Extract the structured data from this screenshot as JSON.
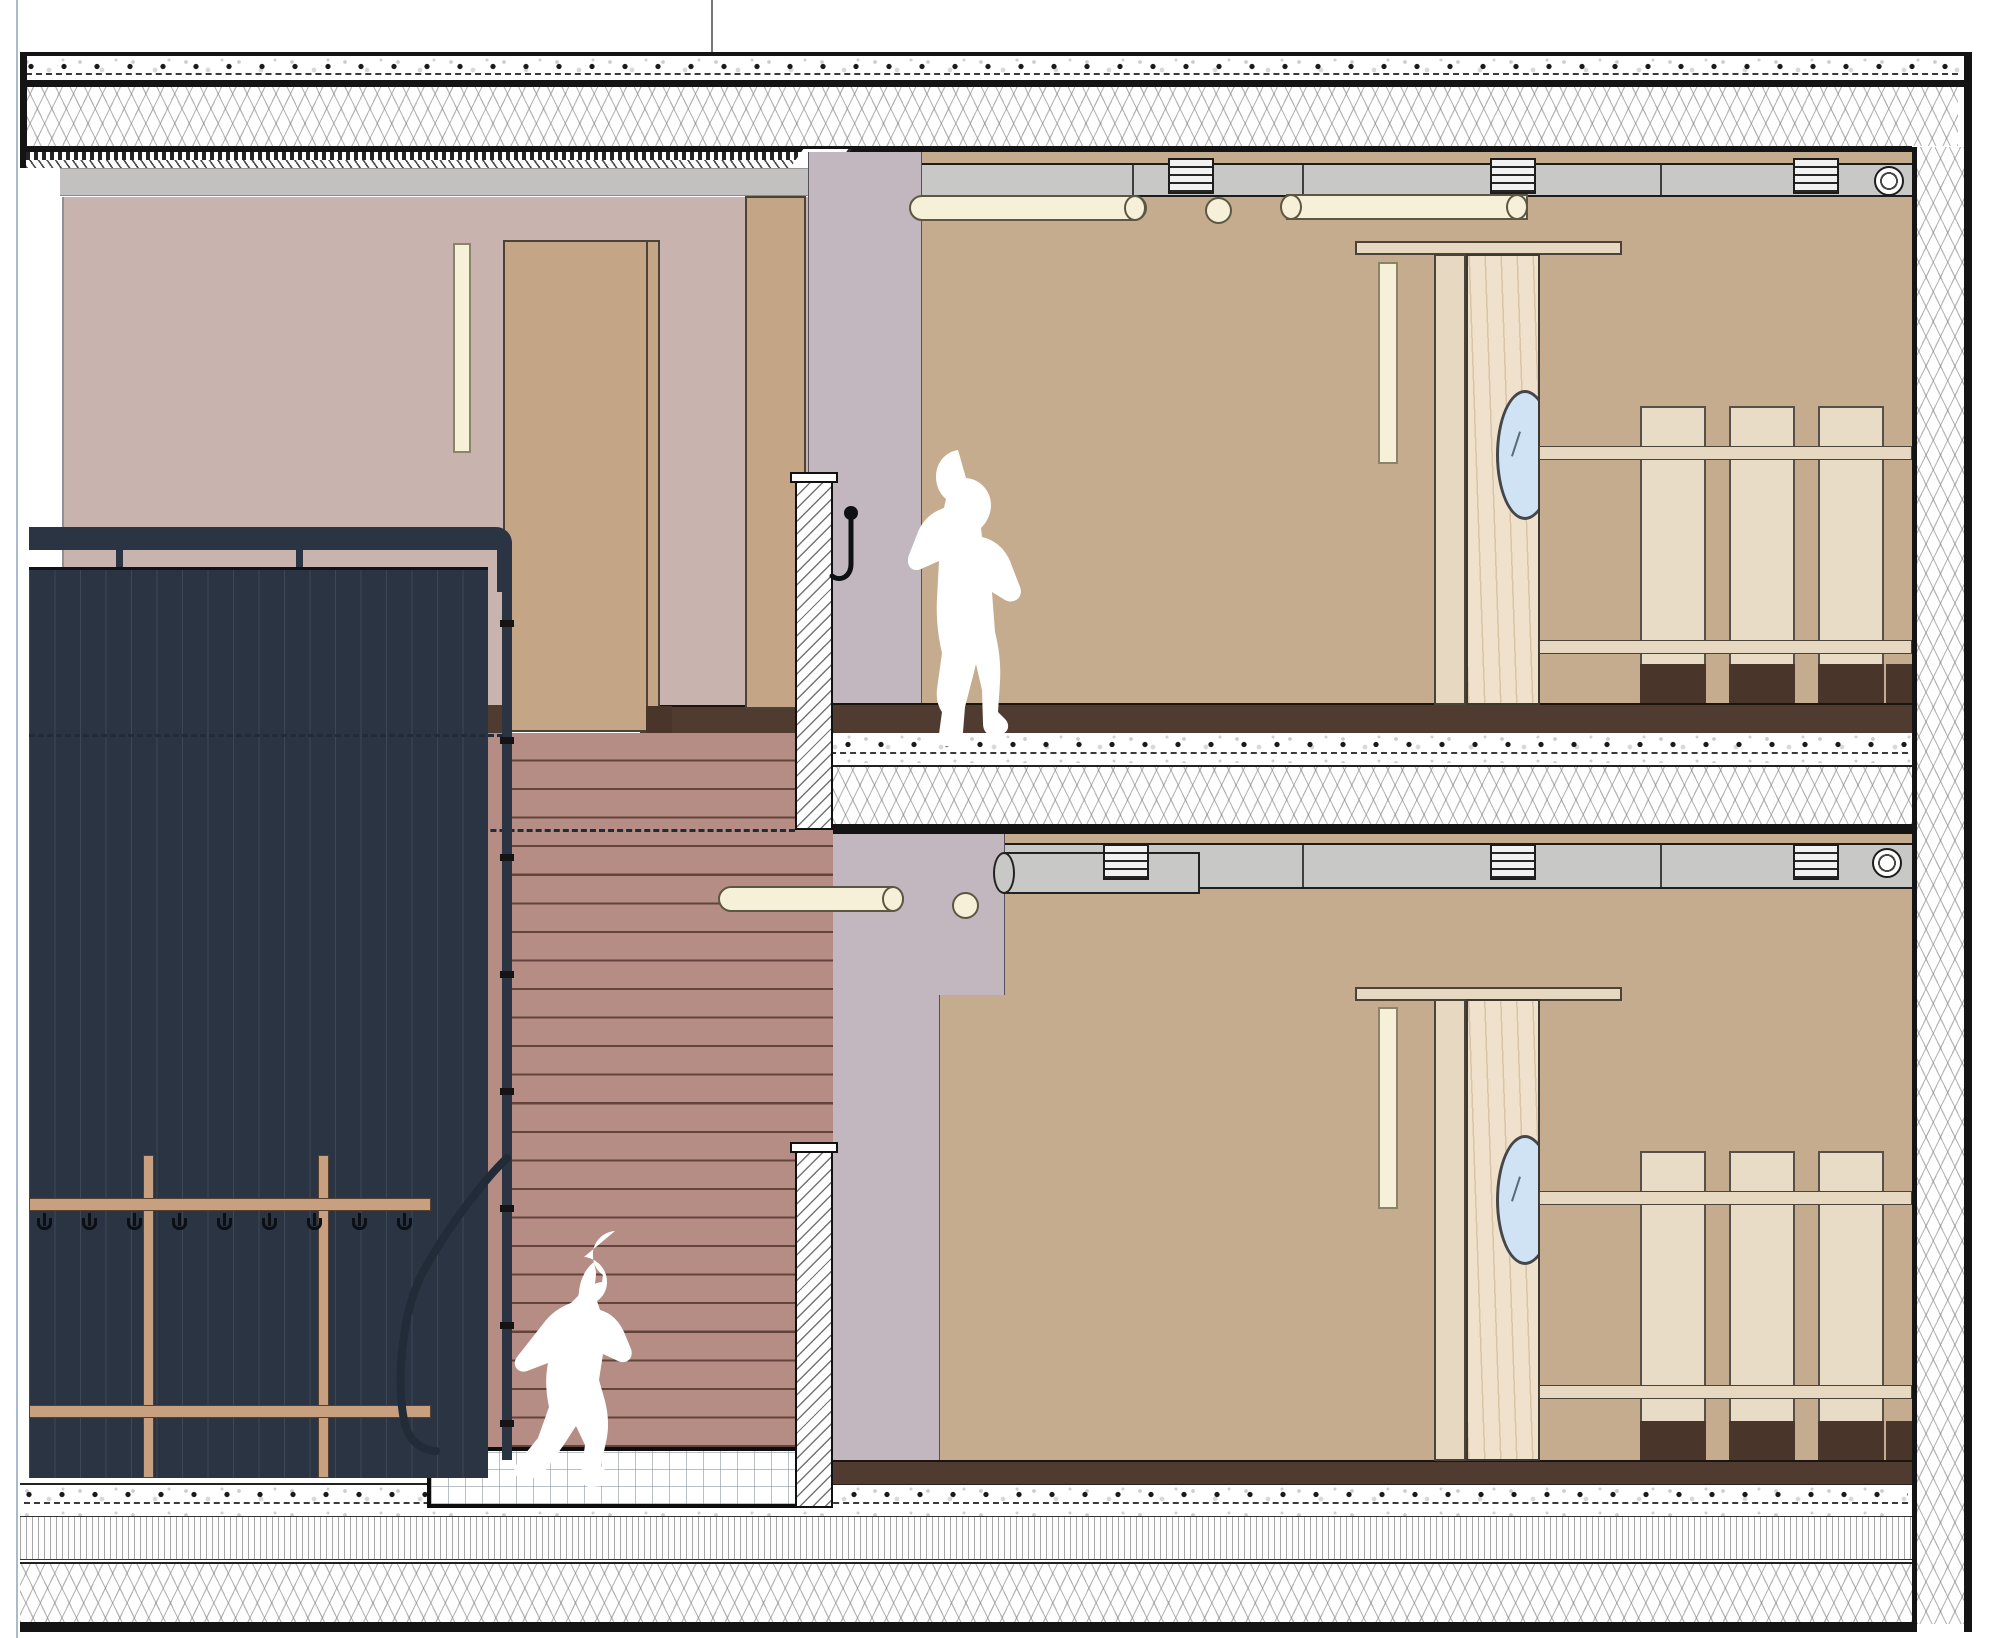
{
  "document": {
    "type": "architectural-section-drawing",
    "subject": "two-storey building section: stair hall with cloakroom panel and two identical rooms with sliding doors and cubby shelving",
    "storeys": 2,
    "visible_text": ""
  },
  "colors": {
    "paper": "#ffffff",
    "ink": "#141414",
    "navyPanel": "#2b3442",
    "mauveWall": "#c9b3ae",
    "lilacWall": "#c2b6bf",
    "tanWall": "#c6ac8f",
    "doorTan": "#c4a687",
    "woodDoor": "#efe1cb",
    "woodFrame": "#e7d8c2",
    "lockerPanel": "#e9dcc6",
    "creamLight": "#f7f0d9",
    "glass": "#cfe3f4",
    "duct": "#c8c8c6",
    "beam": "#c2c1bf",
    "floorBand": "#503b31",
    "stair": "#b58d85",
    "treadLine": "#63443c",
    "coatRail": "#c89f7f",
    "plinth": "#4a352b",
    "pageEdge": "#aabccb"
  },
  "construction": {
    "roof_layers": [
      "membrane-with-fastener-dots",
      "cross-hatch-insulation",
      "deck-strips",
      "gray-edge-beam"
    ],
    "intermediate_floor_layers": [
      "dark-floor-finish-band",
      "screed-with-dot-fasteners",
      "cross-hatch-impact-insulation"
    ],
    "ground_floor_layers": [
      "dark-floor-finish-band",
      "screed-with-dot-fasteners",
      "fine-vertical-hatch-layer",
      "cross-hatch-insulation"
    ],
    "cut_wall_posts": 2,
    "right_exterior_wall": "cross-hatched-insulated-wall"
  },
  "stair": {
    "tread_count": 25,
    "balustrade": "dark-vertical-plank-panel",
    "handrail": "dark-tube-handrail-with-curved-bottom",
    "base_platform": "grid-hatched-plinth",
    "hidden_edge_dashed_lines": 2
  },
  "cloakroom": {
    "coat_rails": 2,
    "coat_posts": 2,
    "hook_count": 9
  },
  "rooms_per_floor": {
    "wall_light_strips": 2,
    "sliding_door": "wood-door-with-oval-porthole",
    "door_track": true,
    "locker_panels": 3,
    "locker_rails": 2,
    "locker_plinths": 4
  },
  "ceiling_fixtures": {
    "upper": {
      "tube_lights": 2,
      "pendant_ball": 1,
      "duct_vents": 3,
      "duct_end_cap": 1
    },
    "lower": {
      "tube_lights": 1,
      "pendant_ball": 1,
      "duct_vents": 3,
      "duct_end_cap": 1,
      "duct_cylinder": 1
    }
  },
  "figures": [
    {
      "name": "child-walking",
      "location": "upper-floor-room",
      "color": "#ffffff"
    },
    {
      "name": "girl-with-ponytail-on-stairs",
      "location": "lower-stair-flight",
      "color": "#ffffff"
    }
  ]
}
